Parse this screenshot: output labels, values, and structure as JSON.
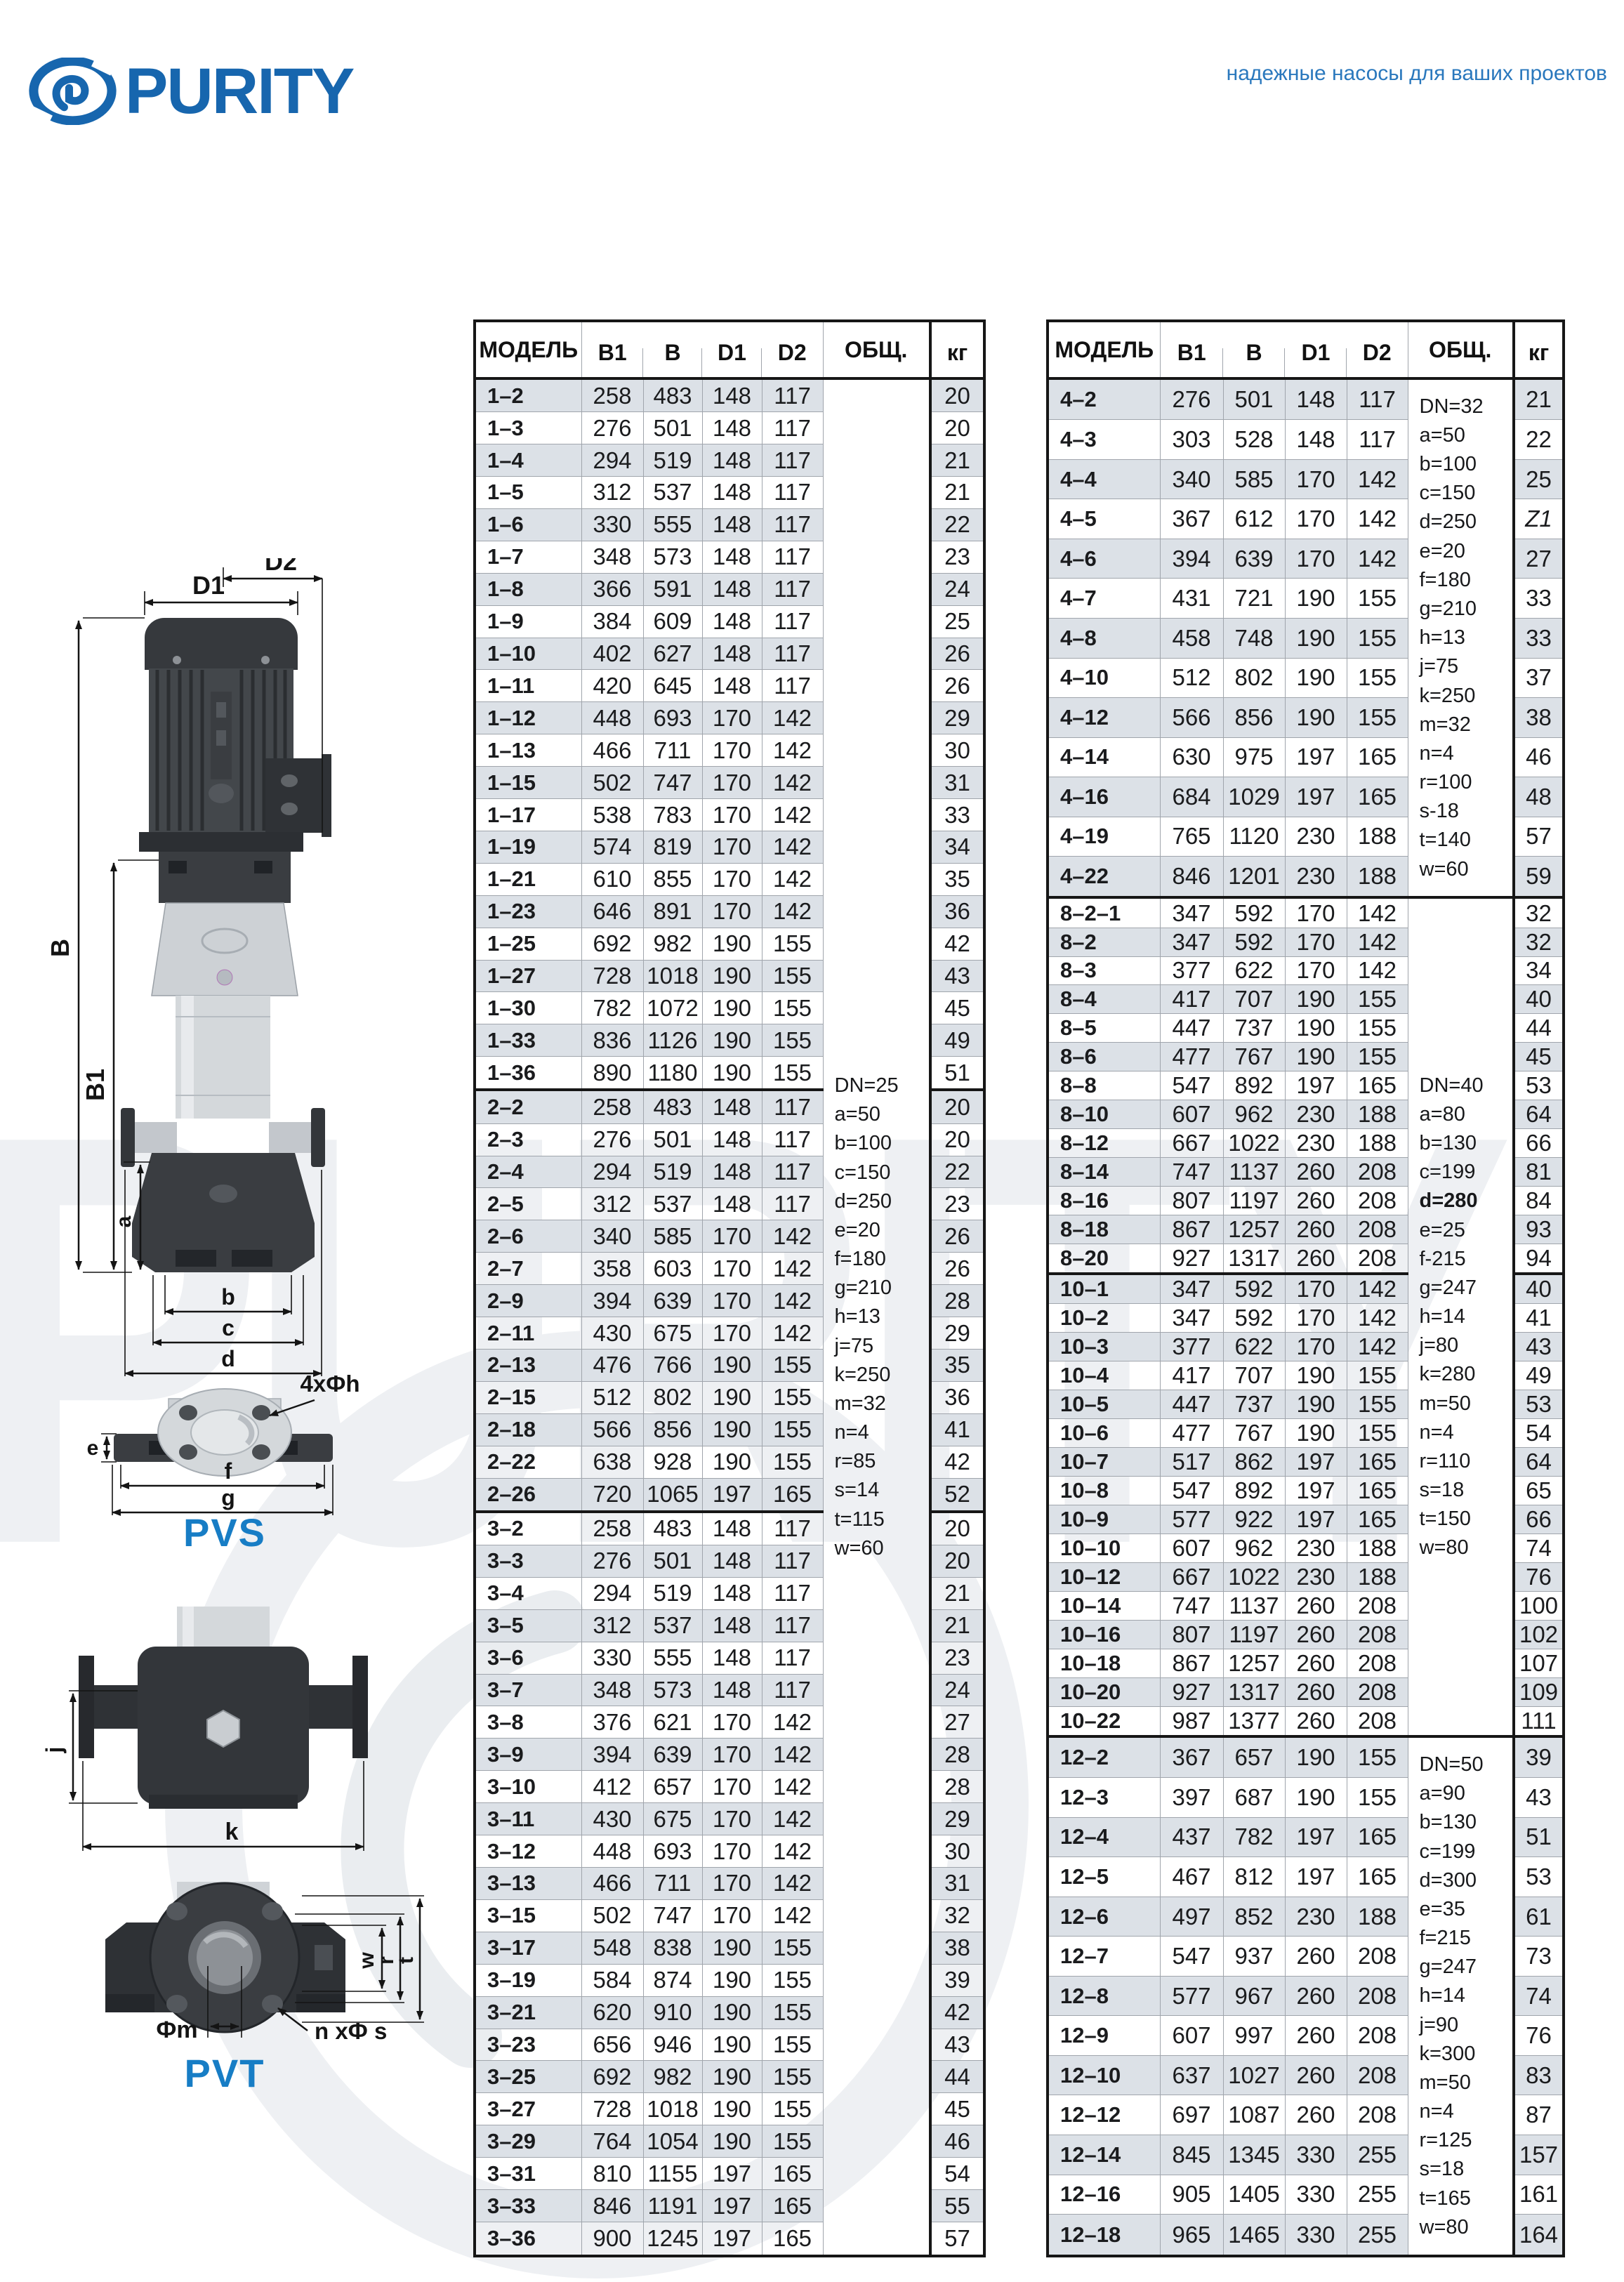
{
  "brand": {
    "logo_text": "PURITY",
    "tagline": "надежные насосы для ваших проектов"
  },
  "colors": {
    "accent": "#1766ae",
    "tagline_blue": "#2a78bd",
    "caption_blue": "#177dc5",
    "stripe": "#dce1e7",
    "grid_line": "#a0a5ac",
    "strong_line": "#161616"
  },
  "diagrams": {
    "pvs": {
      "caption": "PVS",
      "d1": "D1",
      "d2": "D2",
      "b": "B",
      "b1": "B1",
      "a": "a",
      "b_small": "b",
      "c": "c",
      "d": "d",
      "e": "e",
      "f": "f",
      "g": "g",
      "bolt_note": "4xФh"
    },
    "pvt": {
      "caption": "PVT",
      "j": "j",
      "k": "k",
      "w": "w",
      "r": "r",
      "t": "t",
      "fm": "Фm",
      "bolt_note": "n xФ s"
    }
  },
  "table_headers": {
    "model": "МОДЕЛЬ",
    "b1": "B1",
    "b": "B",
    "d1": "D1",
    "d2": "D2",
    "obsh": "ОБЩ.",
    "kg": "кг"
  },
  "left_table": {
    "groups": [
      [
        [
          "1–2",
          258,
          483,
          148,
          117,
          20
        ],
        [
          "1–3",
          276,
          501,
          148,
          117,
          20
        ],
        [
          "1–4",
          294,
          519,
          148,
          117,
          21
        ],
        [
          "1–5",
          312,
          537,
          148,
          117,
          21
        ],
        [
          "1–6",
          330,
          555,
          148,
          117,
          22
        ],
        [
          "1–7",
          348,
          573,
          148,
          117,
          23
        ],
        [
          "1–8",
          366,
          591,
          148,
          117,
          24
        ],
        [
          "1–9",
          384,
          609,
          148,
          117,
          25
        ],
        [
          "1–10",
          402,
          627,
          148,
          117,
          26
        ],
        [
          "1–11",
          420,
          645,
          148,
          117,
          26
        ],
        [
          "1–12",
          448,
          693,
          170,
          142,
          29
        ],
        [
          "1–13",
          466,
          711,
          170,
          142,
          30
        ],
        [
          "1–15",
          502,
          747,
          170,
          142,
          31
        ],
        [
          "1–17",
          538,
          783,
          170,
          142,
          33
        ],
        [
          "1–19",
          574,
          819,
          170,
          142,
          34
        ],
        [
          "1–21",
          610,
          855,
          170,
          142,
          35
        ],
        [
          "1–23",
          646,
          891,
          170,
          142,
          36
        ],
        [
          "1–25",
          692,
          982,
          190,
          155,
          42
        ],
        [
          "1–27",
          728,
          1018,
          190,
          155,
          43
        ],
        [
          "1–30",
          782,
          1072,
          190,
          155,
          45
        ],
        [
          "1–33",
          836,
          1126,
          190,
          155,
          49
        ],
        [
          "1–36",
          890,
          1180,
          190,
          155,
          51
        ]
      ],
      [
        [
          "2–2",
          258,
          483,
          148,
          117,
          20
        ],
        [
          "2–3",
          276,
          501,
          148,
          117,
          20
        ],
        [
          "2–4",
          294,
          519,
          148,
          117,
          22
        ],
        [
          "2–5",
          312,
          537,
          148,
          117,
          23
        ],
        [
          "2–6",
          340,
          585,
          170,
          142,
          26
        ],
        [
          "2–7",
          358,
          603,
          170,
          142,
          26
        ],
        [
          "2–9",
          394,
          639,
          170,
          142,
          28
        ],
        [
          "2–11",
          430,
          675,
          170,
          142,
          29
        ],
        [
          "2–13",
          476,
          766,
          190,
          155,
          35
        ],
        [
          "2–15",
          512,
          802,
          190,
          155,
          36
        ],
        [
          "2–18",
          566,
          856,
          190,
          155,
          41
        ],
        [
          "2–22",
          638,
          928,
          190,
          155,
          42
        ],
        [
          "2–26",
          720,
          1065,
          197,
          165,
          52
        ]
      ],
      [
        [
          "3–2",
          258,
          483,
          148,
          117,
          20
        ],
        [
          "3–3",
          276,
          501,
          148,
          117,
          20
        ],
        [
          "3–4",
          294,
          519,
          148,
          117,
          21
        ],
        [
          "3–5",
          312,
          537,
          148,
          117,
          21
        ],
        [
          "3–6",
          330,
          555,
          148,
          117,
          23
        ],
        [
          "3–7",
          348,
          573,
          148,
          117,
          24
        ],
        [
          "3–8",
          376,
          621,
          170,
          142,
          27
        ],
        [
          "3–9",
          394,
          639,
          170,
          142,
          28
        ],
        [
          "3–10",
          412,
          657,
          170,
          142,
          28
        ],
        [
          "3–11",
          430,
          675,
          170,
          142,
          29
        ],
        [
          "3–12",
          448,
          693,
          170,
          142,
          30
        ],
        [
          "3–13",
          466,
          711,
          170,
          142,
          31
        ],
        [
          "3–15",
          502,
          747,
          170,
          142,
          32
        ],
        [
          "3–17",
          548,
          838,
          190,
          155,
          38
        ],
        [
          "3–19",
          584,
          874,
          190,
          155,
          39
        ],
        [
          "3–21",
          620,
          910,
          190,
          155,
          42
        ],
        [
          "3–23",
          656,
          946,
          190,
          155,
          43
        ],
        [
          "3–25",
          692,
          982,
          190,
          155,
          44
        ],
        [
          "3–27",
          728,
          1018,
          190,
          155,
          45
        ],
        [
          "3–29",
          764,
          1054,
          190,
          155,
          46
        ],
        [
          "3–31",
          810,
          1155,
          197,
          165,
          54
        ],
        [
          "3–33",
          846,
          1191,
          197,
          165,
          55
        ],
        [
          "3–36",
          900,
          1245,
          197,
          165,
          57
        ]
      ]
    ],
    "notes": [
      {
        "at_row": 0,
        "rowspan": 58,
        "bold": [],
        "lines": [
          "DN=25",
          "a=50",
          "b=100",
          "c=150",
          "d=250",
          "e=20",
          "f=180",
          "g=210",
          "h=13",
          "j=75",
          "k=250",
          "m=32",
          "n=4",
          "r=85",
          "s=14",
          "t=115",
          "w=60"
        ]
      }
    ]
  },
  "right_table": {
    "groups": [
      [
        [
          "4–2",
          276,
          501,
          148,
          117,
          21
        ],
        [
          "4–3",
          303,
          528,
          148,
          117,
          22
        ],
        [
          "4–4",
          340,
          585,
          170,
          142,
          25
        ],
        [
          "4–5",
          367,
          612,
          170,
          142,
          "Z1"
        ],
        [
          "4–6",
          394,
          639,
          170,
          142,
          27
        ],
        [
          "4–7",
          431,
          721,
          190,
          155,
          33
        ],
        [
          "4–8",
          458,
          748,
          190,
          155,
          33
        ],
        [
          "4–10",
          512,
          802,
          190,
          155,
          37
        ],
        [
          "4–12",
          566,
          856,
          190,
          155,
          38
        ],
        [
          "4–14",
          630,
          975,
          197,
          165,
          46
        ],
        [
          "4–16",
          684,
          1029,
          197,
          165,
          48
        ],
        [
          "4–19",
          765,
          1120,
          230,
          188,
          57
        ],
        [
          "4–22",
          846,
          1201,
          230,
          188,
          59
        ]
      ],
      [
        [
          "8–2–1",
          347,
          592,
          170,
          142,
          32
        ],
        [
          "8–2",
          347,
          592,
          170,
          142,
          32
        ],
        [
          "8–3",
          377,
          622,
          170,
          142,
          34
        ],
        [
          "8–4",
          417,
          707,
          190,
          155,
          40
        ],
        [
          "8–5",
          447,
          737,
          190,
          155,
          44
        ],
        [
          "8–6",
          477,
          767,
          190,
          155,
          45
        ],
        [
          "8–8",
          547,
          892,
          197,
          165,
          53
        ],
        [
          "8–10",
          607,
          962,
          230,
          188,
          64
        ],
        [
          "8–12",
          667,
          1022,
          230,
          188,
          66
        ],
        [
          "8–14",
          747,
          1137,
          260,
          208,
          81
        ],
        [
          "8–16",
          807,
          1197,
          260,
          208,
          84
        ],
        [
          "8–18",
          867,
          1257,
          260,
          208,
          93
        ],
        [
          "8–20",
          927,
          1317,
          260,
          208,
          94
        ]
      ],
      [
        [
          "10–1",
          347,
          592,
          170,
          142,
          40
        ],
        [
          "10–2",
          347,
          592,
          170,
          142,
          41
        ],
        [
          "10–3",
          377,
          622,
          170,
          142,
          43
        ],
        [
          "10–4",
          417,
          707,
          190,
          155,
          49
        ],
        [
          "10–5",
          447,
          737,
          190,
          155,
          53
        ],
        [
          "10–6",
          477,
          767,
          190,
          155,
          54
        ],
        [
          "10–7",
          517,
          862,
          197,
          165,
          64
        ],
        [
          "10–8",
          547,
          892,
          197,
          165,
          65
        ],
        [
          "10–9",
          577,
          922,
          197,
          165,
          66
        ],
        [
          "10–10",
          607,
          962,
          230,
          188,
          74
        ],
        [
          "10–12",
          667,
          1022,
          230,
          188,
          76
        ],
        [
          "10–14",
          747,
          1137,
          260,
          208,
          100
        ],
        [
          "10–16",
          807,
          1197,
          260,
          208,
          102
        ],
        [
          "10–18",
          867,
          1257,
          260,
          208,
          107
        ],
        [
          "10–20",
          927,
          1317,
          260,
          208,
          109
        ],
        [
          "10–22",
          987,
          1377,
          260,
          208,
          111
        ]
      ],
      [
        [
          "12–2",
          367,
          657,
          190,
          155,
          39
        ],
        [
          "12–3",
          397,
          687,
          190,
          155,
          43
        ],
        [
          "12–4",
          437,
          782,
          197,
          165,
          51
        ],
        [
          "12–5",
          467,
          812,
          197,
          165,
          53
        ],
        [
          "12–6",
          497,
          852,
          230,
          188,
          61
        ],
        [
          "12–7",
          547,
          937,
          260,
          208,
          73
        ],
        [
          "12–8",
          577,
          967,
          260,
          208,
          74
        ],
        [
          "12–9",
          607,
          997,
          260,
          208,
          76
        ],
        [
          "12–10",
          637,
          1027,
          260,
          208,
          83
        ],
        [
          "12–12",
          697,
          1087,
          260,
          208,
          87
        ],
        [
          "12–14",
          845,
          1345,
          330,
          255,
          157
        ],
        [
          "12–16",
          905,
          1405,
          330,
          255,
          161
        ],
        [
          "12–18",
          965,
          1465,
          330,
          255,
          164
        ]
      ]
    ],
    "notes": [
      {
        "at_row": 0,
        "rowspan": 13,
        "bold": [],
        "lines": [
          "DN=32",
          "a=50",
          "b=100",
          "c=150",
          "d=250",
          "e=20",
          "f=180",
          "g=210",
          "h=13",
          "j=75",
          "k=250",
          "m=32",
          "n=4",
          "r=100",
          "s-18",
          "t=140",
          "w=60"
        ]
      },
      {
        "at_row": 13,
        "rowspan": 29,
        "bold": [
          "d=280"
        ],
        "lines": [
          "DN=40",
          "a=80",
          "b=130",
          "c=199",
          "d=280",
          "e=25",
          "f-215",
          "g=247",
          "h=14",
          "j=80",
          "k=280",
          "m=50",
          "n=4",
          "r=110",
          "s=18",
          "t=150",
          "w=80"
        ]
      },
      {
        "at_row": 42,
        "rowspan": 13,
        "bold": [],
        "lines": [
          "DN=50",
          "a=90",
          "b=130",
          "c=199",
          "d=300",
          "e=35",
          "f=215",
          "g=247",
          "h=14",
          "j=90",
          "k=300",
          "m=50",
          "n=4",
          "r=125",
          "s=18",
          "t=165",
          "w=80"
        ]
      }
    ]
  }
}
